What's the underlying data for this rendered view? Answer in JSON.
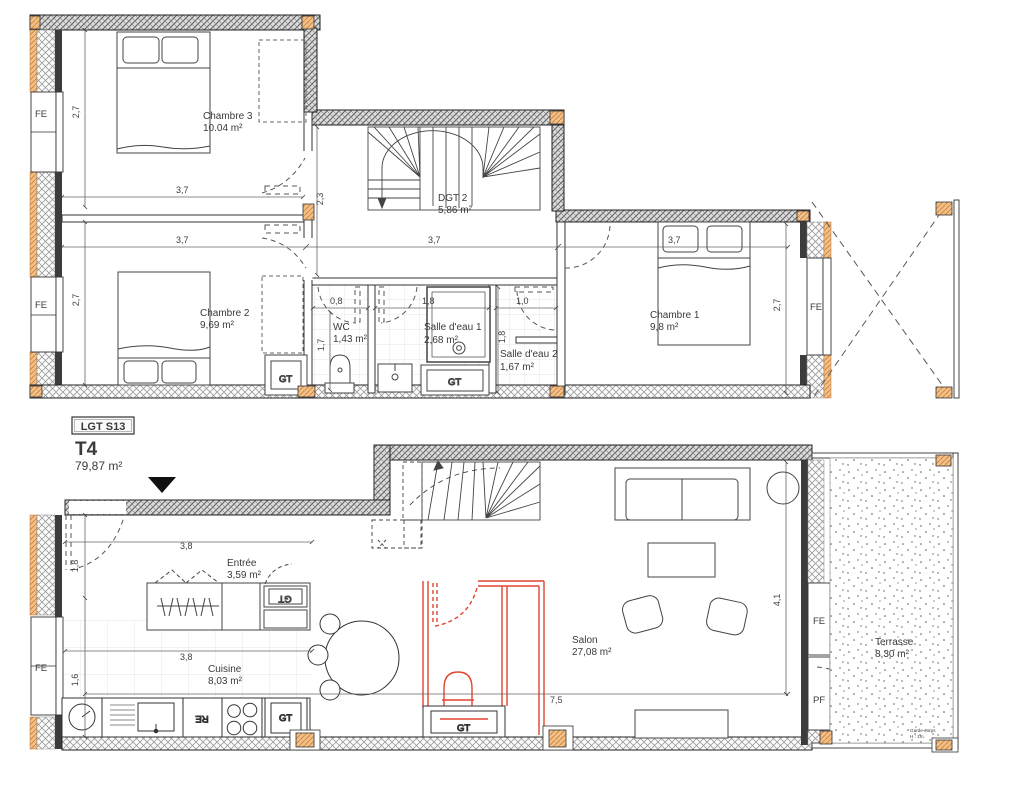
{
  "title_block": {
    "unit_code": "LGT S13",
    "unit_type": "T4",
    "unit_area": "79,87 m²"
  },
  "upper_floor": {
    "rooms": {
      "chambre3": {
        "name": "Chambre 3",
        "area": "10.04 m²"
      },
      "dgt2": {
        "name": "DGT 2",
        "area": "5,86 m²"
      },
      "chambre2": {
        "name": "Chambre 2",
        "area": "9,69 m²"
      },
      "wc": {
        "name": "WC",
        "area": "1,43 m²"
      },
      "salle_deau_1": {
        "name": "Salle d'eau 1",
        "area": "2,68 m²"
      },
      "salle_deau_2": {
        "name": "Salle d'eau 2",
        "area": "1,67 m²"
      },
      "chambre1": {
        "name": "Chambre 1",
        "area": "9,8 m²"
      }
    },
    "dimensions": {
      "chambre3_width": "3,7",
      "chambre3_depth": "2,7",
      "chambre2_width": "3,7",
      "chambre2_depth": "2,7",
      "corridor_width": "3,7",
      "dgt2_depth": "2,3",
      "wc_width": "0,8",
      "wc_depth": "1,7",
      "salle_deau1_width": "1,8",
      "salle_deau2_entry": "1,0",
      "salle_deau2_depth": "1,8",
      "chambre1_width": "3,7",
      "chambre1_depth": "2,7"
    },
    "window_labels": {
      "left_top": "FE",
      "left_bottom": "FE",
      "right": "FE"
    },
    "duct_labels": {
      "gt1": "GT",
      "gt2": "GT"
    }
  },
  "lower_floor": {
    "rooms": {
      "entree": {
        "name": "Entrée",
        "area": "3,59 m²"
      },
      "cuisine": {
        "name": "Cuisine",
        "area": "8,03 m²"
      },
      "salon": {
        "name": "Salon",
        "area": "27,08 m²"
      },
      "terrasse": {
        "name": "Terrasse",
        "area": "8,30 m²"
      }
    },
    "dimensions": {
      "entree_width": "3,8",
      "entree_depth": "1,8",
      "cuisine_width": "3,8",
      "cuisine_depth": "1,6",
      "salon_width": "7,5",
      "salon_depth": "4,1"
    },
    "window_labels": {
      "left": "FE",
      "right_fe": "FE",
      "right_pf": "PF"
    },
    "appliance_labels": {
      "fridge": "RE"
    },
    "duct_labels": {
      "entree_gt": "GT",
      "cuisine_gt": "GT",
      "wc_gt": "GT"
    },
    "terrace_note_line1": "Garde-corps",
    "terrace_note_line2": "H : 1m."
  },
  "colors": {
    "wall_hatch": "#8a8a8a",
    "timber_post": "#eeb273",
    "red_variant": "#e2442e",
    "text": "#3c3c3c"
  }
}
